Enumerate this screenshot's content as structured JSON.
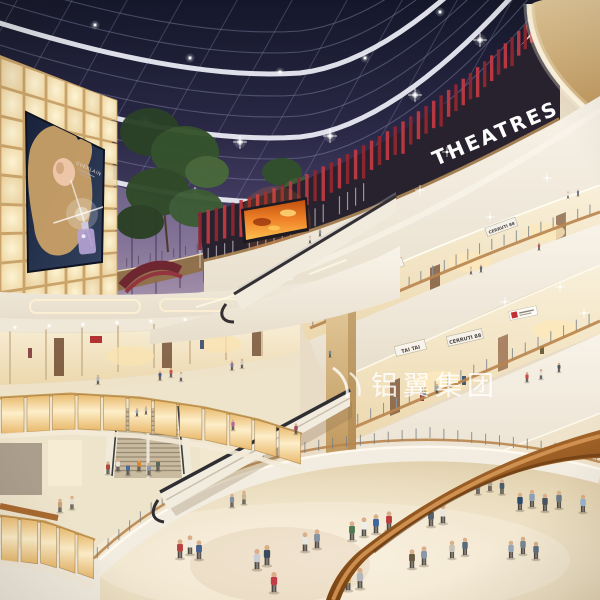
{
  "scene": {
    "setting": "multi-level shopping mall atrium at night",
    "style": "3D architectural rendering"
  },
  "signs": {
    "theatres": "THEATRES",
    "store_tai_tai_upper": "TAI TAI",
    "store_cerruti_upper": "CERRUTI 88",
    "store_tai_tai_lower": "TAI TAI",
    "store_cerruti_lower": "CERRUTI 88",
    "store_air": "AIR",
    "billboard_brand": "GUERLAIN"
  },
  "watermark": {
    "text": "铝翼集团"
  },
  "colors": {
    "sky_navy": "#15182a",
    "dusk_purple": "#9c8aa6",
    "theatre_red": "#c03a43",
    "wood_tan": "#d9bd8d",
    "amber_glow": "#f3c87e",
    "fascia_white": "#f3eee2",
    "floor_beige": "#e9dcc6",
    "rail_brown": "#9a581f",
    "screen_orange": "#f08030",
    "watermark_white": "#ffffff"
  }
}
